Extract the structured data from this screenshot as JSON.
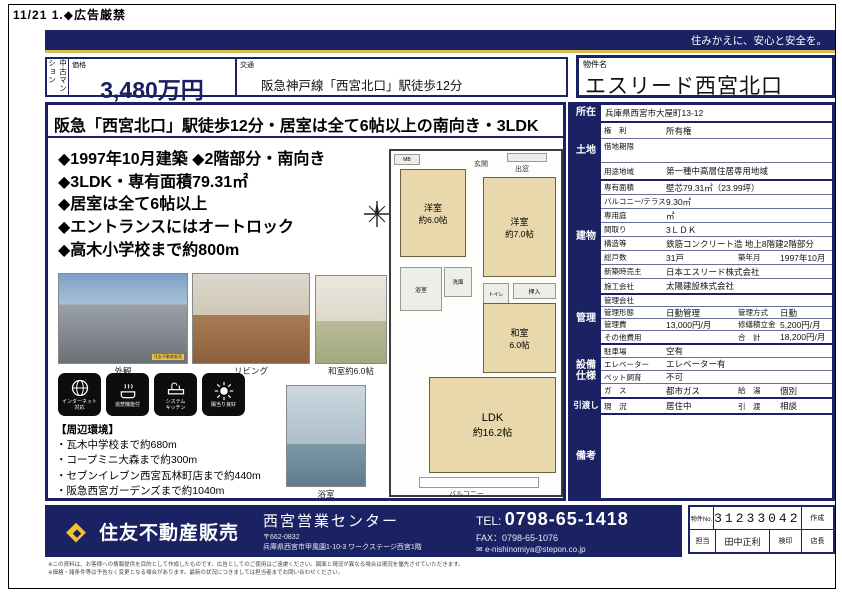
{
  "page": {
    "top_note": "11/21 1.◆広告厳禁",
    "tagline": "住みかえに、安心と安全を。"
  },
  "header": {
    "category_vertical": "中古マンション",
    "price_label": "価格",
    "price_value": "3,480万円",
    "traffic_label": "交通",
    "traffic_value": "阪急神戸線「西宮北口」駅徒歩12分",
    "name_label": "物件名",
    "name_value": "エスリード西宮北口"
  },
  "main": {
    "headline": "阪急「西宮北口」駅徒歩12分・居室は全て6帖以上の南向き・3LDK",
    "bullets": [
      "◆1997年10月建築 ◆2階部分・南向き",
      "◆3LDK・専有面積79.31㎡",
      "◆居室は全て6帖以上",
      "◆エントランスにはオートロック",
      "◆高木小学校まで約800m"
    ],
    "photos": [
      {
        "caption": "外観",
        "watermark": "住友不動産販売"
      },
      {
        "caption": "リビング"
      },
      {
        "caption": "和室約6.0帖"
      },
      {
        "caption": "浴室"
      }
    ],
    "feature_icons": [
      {
        "icon": "internet-icon",
        "label": "インターネット\n対応"
      },
      {
        "icon": "reheat-bath-icon",
        "label": "追焚機能付"
      },
      {
        "icon": "system-kitchen-icon",
        "label": "システム\nキッチン"
      },
      {
        "icon": "sunny-icon",
        "label": "陽当り良好"
      }
    ],
    "surroundings_title": "【周辺環境】",
    "surroundings": [
      "・瓦木中学校まで約680m",
      "・コープミニ大森まで約300m",
      "・セブンイレブン西宮瓦林町店まで約440m",
      "・阪急西宮ガーデンズまで約1040m"
    ],
    "floorplan": {
      "rooms": [
        {
          "name": "洋室",
          "size": "約6.0帖"
        },
        {
          "name": "洋室",
          "size": "約7.0帖"
        },
        {
          "name": "和室",
          "size": "6.0帖"
        },
        {
          "name": "LDK",
          "size": "約16.2帖"
        }
      ],
      "labels": {
        "mb": "MB",
        "bay_window": "出窓",
        "entrance": "玄関",
        "bath": "浴室",
        "washroom": "洗面",
        "toilet": "トイレ",
        "closet": "押入",
        "balcony": "バルコニー"
      }
    }
  },
  "spec": {
    "sections": [
      "所在",
      "土地",
      "建物",
      "管理",
      "設備\n仕様",
      "引渡し",
      "備考"
    ],
    "rows": [
      {
        "v1": "兵庫県西宮市大屋町13-12"
      },
      {
        "l1": "権　利",
        "v1": "所有権"
      },
      {
        "l1": "借地期限",
        "v1": ""
      },
      {
        "l1": "用途地域",
        "v1": "第一種中高層住居専用地域"
      },
      {
        "l1": "専有面積",
        "v1": "壁芯79.31㎡（23.99坪）"
      },
      {
        "l1": "バルコニー/テラス",
        "v1": "9.30㎡"
      },
      {
        "l1": "専用庭",
        "v1": "㎡"
      },
      {
        "l1": "間取り",
        "v1": "3ＬＤＫ"
      },
      {
        "l1": "構造等",
        "v1": "鉄筋コンクリート造 地上8階建2階部分"
      },
      {
        "l1": "総戸数",
        "v1": "31戸",
        "l2": "築年月",
        "v2": "1997年10月"
      },
      {
        "l1": "新築時売主",
        "v1": "日本エスリード株式会社"
      },
      {
        "l1": "施工会社",
        "v1": "太陽建設株式会社"
      },
      {
        "l1": "管理会社",
        "v1": ""
      },
      {
        "l1": "管理形態",
        "v1": "日勤管理",
        "l2": "管理方式",
        "v2": "日勤"
      },
      {
        "l1": "管理費",
        "v1": "13,000円/月",
        "l2": "修繕積立金",
        "v2": "5,200円/月"
      },
      {
        "l1": "その他費用",
        "v1": "",
        "l2": "合　計",
        "v2": "18,200円/月"
      },
      {
        "l1": "駐車場",
        "v1": "空有"
      },
      {
        "l1": "エレベーター",
        "v1": "エレベーター有"
      },
      {
        "l1": "ペット飼育",
        "v1": "不可"
      },
      {
        "l1": "ガ　ス",
        "v1": "都市ガス",
        "l2": "給　湯",
        "v2": "個別"
      },
      {
        "l1": "現　況",
        "v1": "居住中",
        "l2": "引　渡",
        "v2": "相談"
      }
    ]
  },
  "footer": {
    "brand": "住友不動産販売",
    "center_name": "西宮営業センター",
    "postal": "〒662-0832",
    "address": "兵庫県西宮市甲風園1-10-3 ワークステージ西宮1階",
    "tel_label": "TEL:",
    "tel_value": "0798-65-1418",
    "fax_line": "FAX：0798-65-1076",
    "email": "e-nishinomiya@stepon.co.jp",
    "stamp": {
      "no_label": "物件No.",
      "no_value": "31233042",
      "made_label": "作成",
      "staff_label": "担当",
      "staff_value": "田中正利",
      "check_label": "検印",
      "chief_label": "店長"
    }
  },
  "disclaimer": {
    "line1": "※この資料は、お客様への情報提供を目的として作成したものです。広告としてのご使用はご遠慮ください。図面と現況が異なる場合は現況を優先させていただきます。",
    "line2": "※価格・諸条件等は予告なく変更となる場合があります。最新の状況につきましては担当者までお問い合わせください。"
  }
}
